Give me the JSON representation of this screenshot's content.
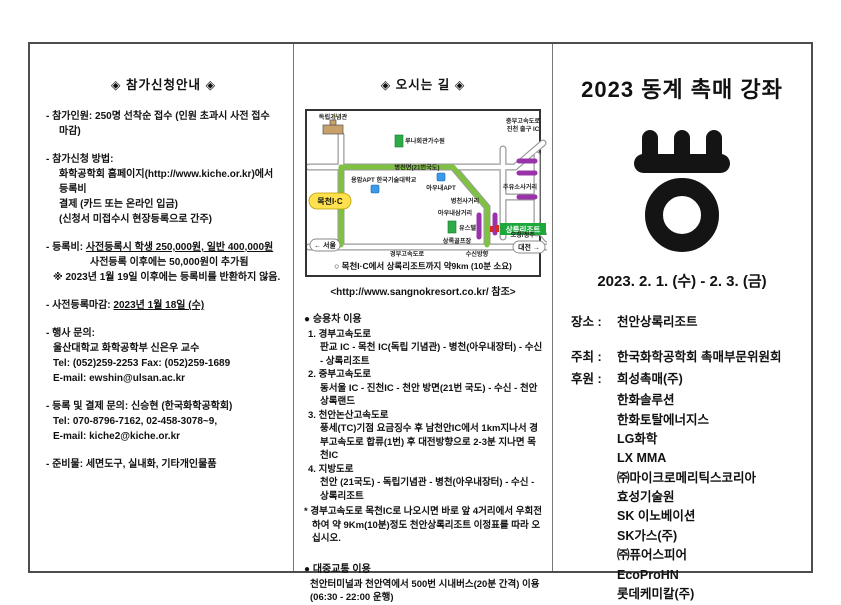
{
  "page": {
    "bg": "#ffffff",
    "border_color": "#4d4d4d"
  },
  "left": {
    "title": "◈ 참가신청안내 ◈",
    "capacity": "- 참가인원: 250명 선착순 접수 (인원 초과시 사전 접수 마감)",
    "apply": {
      "head": "- 참가신청 방법:",
      "line1": "화학공학회 홈페이지(http://www.kiche.or.kr)에서 등록비",
      "line2": "결제 (카드 또는 온라인 입금)",
      "line3": "(신청서 미접수시 현장등록으로 간주)"
    },
    "fee": {
      "prefix": "- 등록비: ",
      "underlined": "사전등록시 학생 250,000원, 일반 400,000원",
      "line2": "사전등록 이후에는 50,000원이 추가됨",
      "line3": "※ 2023년 1월 19일 이후에는 등록비를 반환하지 않음."
    },
    "deadline": {
      "prefix": "- 사전등록마감: ",
      "value": "2023년 1월 18일 (수)"
    },
    "event_contact": {
      "head": "- 행사 문의:",
      "line1": "울산대학교 화학공학부 신은우 교수",
      "line2": "Tel: (052)259-2253   Fax: (052)259-1689",
      "line3": "E-mail: ewshin@ulsan.ac.kr"
    },
    "reg_contact": {
      "head": "- 등록 및 결제 문의: 신승현 (한국화학공학회)",
      "line1": "Tel: 070-8796-7162, 02-458-3078~9,",
      "line2": "E-mail: kiche2@kiche.or.kr"
    },
    "supplies": "- 준비물: 세면도구, 실내화, 기타개인물품"
  },
  "middle": {
    "title": "◈ 오시는 길 ◈",
    "map": {
      "labels": {
        "memorial": "독립기념관",
        "luna": "루나회관가수원",
        "byeongcheon_road": "병천면(21번국도)",
        "apt_univ": "용암APT 한국기술대학교",
        "aunae_apt": "아우내APT",
        "jungbu_ic1": "중부고속도로",
        "jungbu_ic2": "진천 출구 IC",
        "gas_cross": "주유소사거리",
        "byeongcheon_cross": "병천사거리",
        "aunae_cross": "아우내삼거리",
        "youth_hostel": "유스텔",
        "golf": "상록골프장",
        "resort": "상록리조트",
        "ochang": "오창/청주",
        "seoul": "← 서울",
        "gyeongbu": "경부고속도로",
        "susin": "수신방향",
        "daejeon": "대전 →",
        "mokcheon_ic": "목천I·C"
      },
      "caption": "○ 목천I·C에서 상록리조트까지 약9km (10분 소요)",
      "route_color": "#7fc241",
      "marker_color": "#9933aa",
      "ic_color": "#ffe14d",
      "resort_color": "#1ea83c"
    },
    "site_ref": "<http://www.sangnokresort.co.kr/ 참조>",
    "car": {
      "header": "● 승용차 이용",
      "routes": [
        {
          "num": "1.",
          "name": "경부고속도로",
          "desc": "판교 IC - 목천 IC(독립 기념관) - 병천(아우내장터) - 수신 - 상록리조트"
        },
        {
          "num": "2.",
          "name": "중부고속도로",
          "desc": "동서울 IC - 진천IC - 천안 방면(21번 국도) - 수신 - 천안상록랜드"
        },
        {
          "num": "3.",
          "name": "천안논산고속도로",
          "desc": "풍세(TC)기점 요금징수 후 남천안IC에서 1km지나서 경부고속도로 합류(1번) 후 대전방향으로 2-3분 지나면 목천IC"
        },
        {
          "num": "4.",
          "name": "지방도로",
          "desc": "천안 (21국도) - 독립기념관 - 병천(아우내장터) - 수신 - 상록리조트"
        }
      ],
      "note": "* 경부고속도로 목천IC로 나오시면 바로 앞 4거리에서 우회전하여 약 9Km(10분)정도 천안상록리조트 이정표를 따라 오십시오."
    },
    "transit": {
      "header": "● 대중교통 이용",
      "desc": "천안터미널과 천안역에서 500번 시내버스(20분 간격) 이용 (06:30 - 22:00 운행)"
    }
  },
  "right": {
    "title": "2023 동계 촉매 강좌",
    "dates": "2023. 2. 1. (수) - 2. 3. (금)",
    "venue_label": "장소 :",
    "venue": "천안상록리조트",
    "host_label": "주최 :",
    "host": "한국화학공학회 촉매부문위원회",
    "sponsor_label": "후원 :",
    "sponsors": [
      "희성촉매(주)",
      "한화솔루션",
      "한화토탈에너지스",
      "LG화학",
      "LX MMA",
      "㈜마이크로메리틱스코리아",
      "효성기술원",
      "SK 이노베이션",
      "SK가스(주)",
      "㈜퓨어스피어",
      "EcoProHN",
      "롯데케미칼(주)"
    ]
  }
}
